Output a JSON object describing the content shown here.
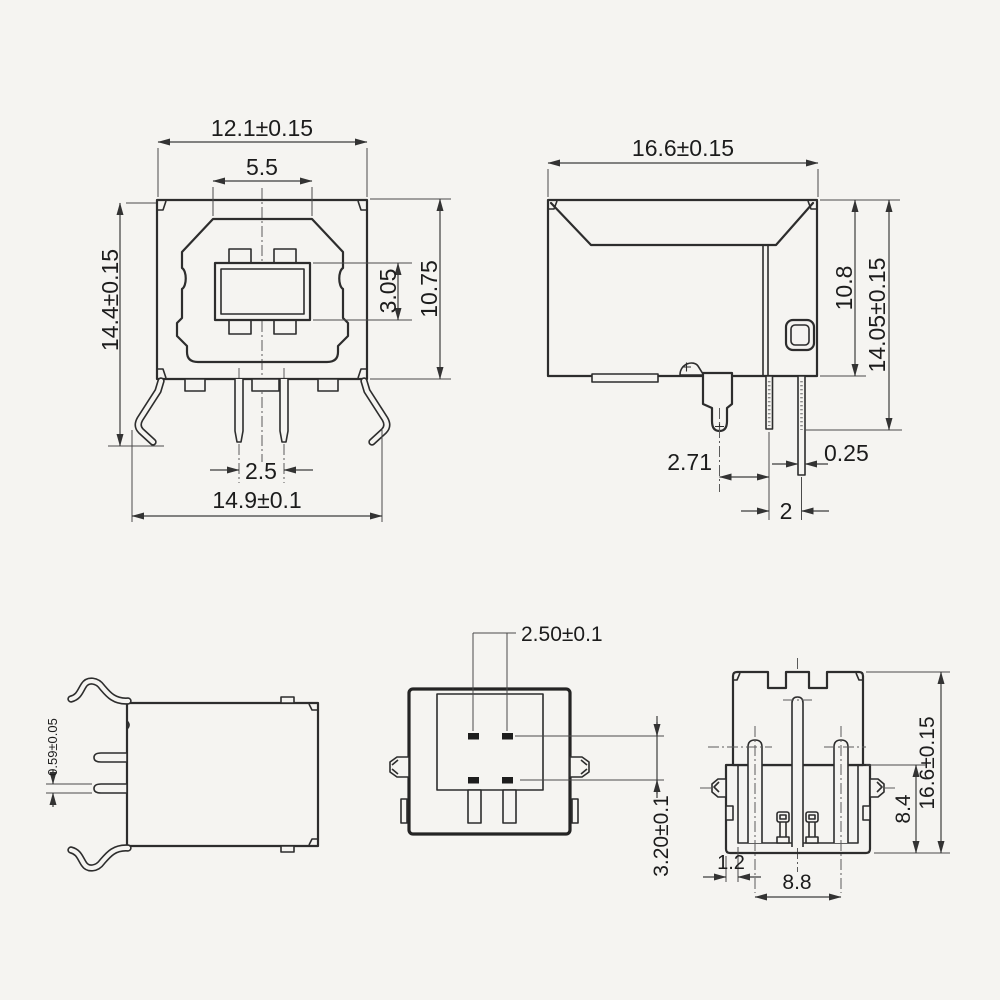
{
  "drawing": {
    "front": {
      "width": "12.1±0.15",
      "inner_width": "5.5",
      "height": "14.4±0.15",
      "tongue_height": "3.05",
      "shell_height": "10.75",
      "pin_pitch": "2.5",
      "overall_width": "14.9±0.1"
    },
    "side": {
      "depth": "16.6±0.15",
      "body_height": "10.8",
      "overall_height": "14.05±0.15",
      "peg_to_pin": "2.71",
      "pin_thickness": "0.25",
      "pin_spacing": "2"
    },
    "top": {
      "leg_thickness": "0.59±0.05"
    },
    "rear": {
      "pad_pitch": "2.50±0.1",
      "row_spacing": "3.20±0.1"
    },
    "bottom": {
      "depth": "16.6±0.15",
      "body_depth": "8.4",
      "wall": "1.2",
      "pin_span": "8.8"
    }
  },
  "colors": {
    "background": "#f5f4f1",
    "line": "#2d2d2d",
    "dim_line": "#3c3c3c",
    "text": "#1c1c1c"
  }
}
